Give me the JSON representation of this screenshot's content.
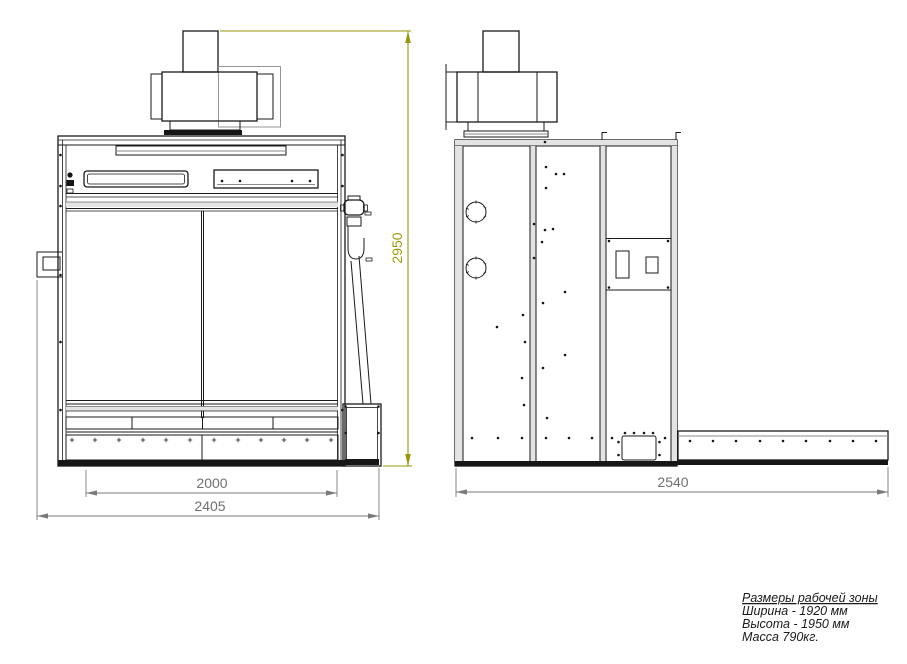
{
  "drawing": {
    "type": "technical-two-view-drawing",
    "subject": "blast-cabinet machine, front and side orthographic views",
    "colors": {
      "line": "#1a1a1a",
      "secondary_line": "#8a8a8a",
      "dimension": "#7a7a7a",
      "height_dimension_accent": "#97970b"
    },
    "front_view": {
      "dimensions": {
        "opening_width": "2000",
        "overall_width": "2405",
        "overall_height": "2950"
      }
    },
    "side_view": {
      "dimensions": {
        "overall_depth": "2540"
      }
    },
    "notes": {
      "title": "Размеры рабочей зоны",
      "width_line": "Ширина - 1920 мм",
      "height_line": "Высота - 1950 мм",
      "mass_line": "Масса 790кг."
    }
  }
}
